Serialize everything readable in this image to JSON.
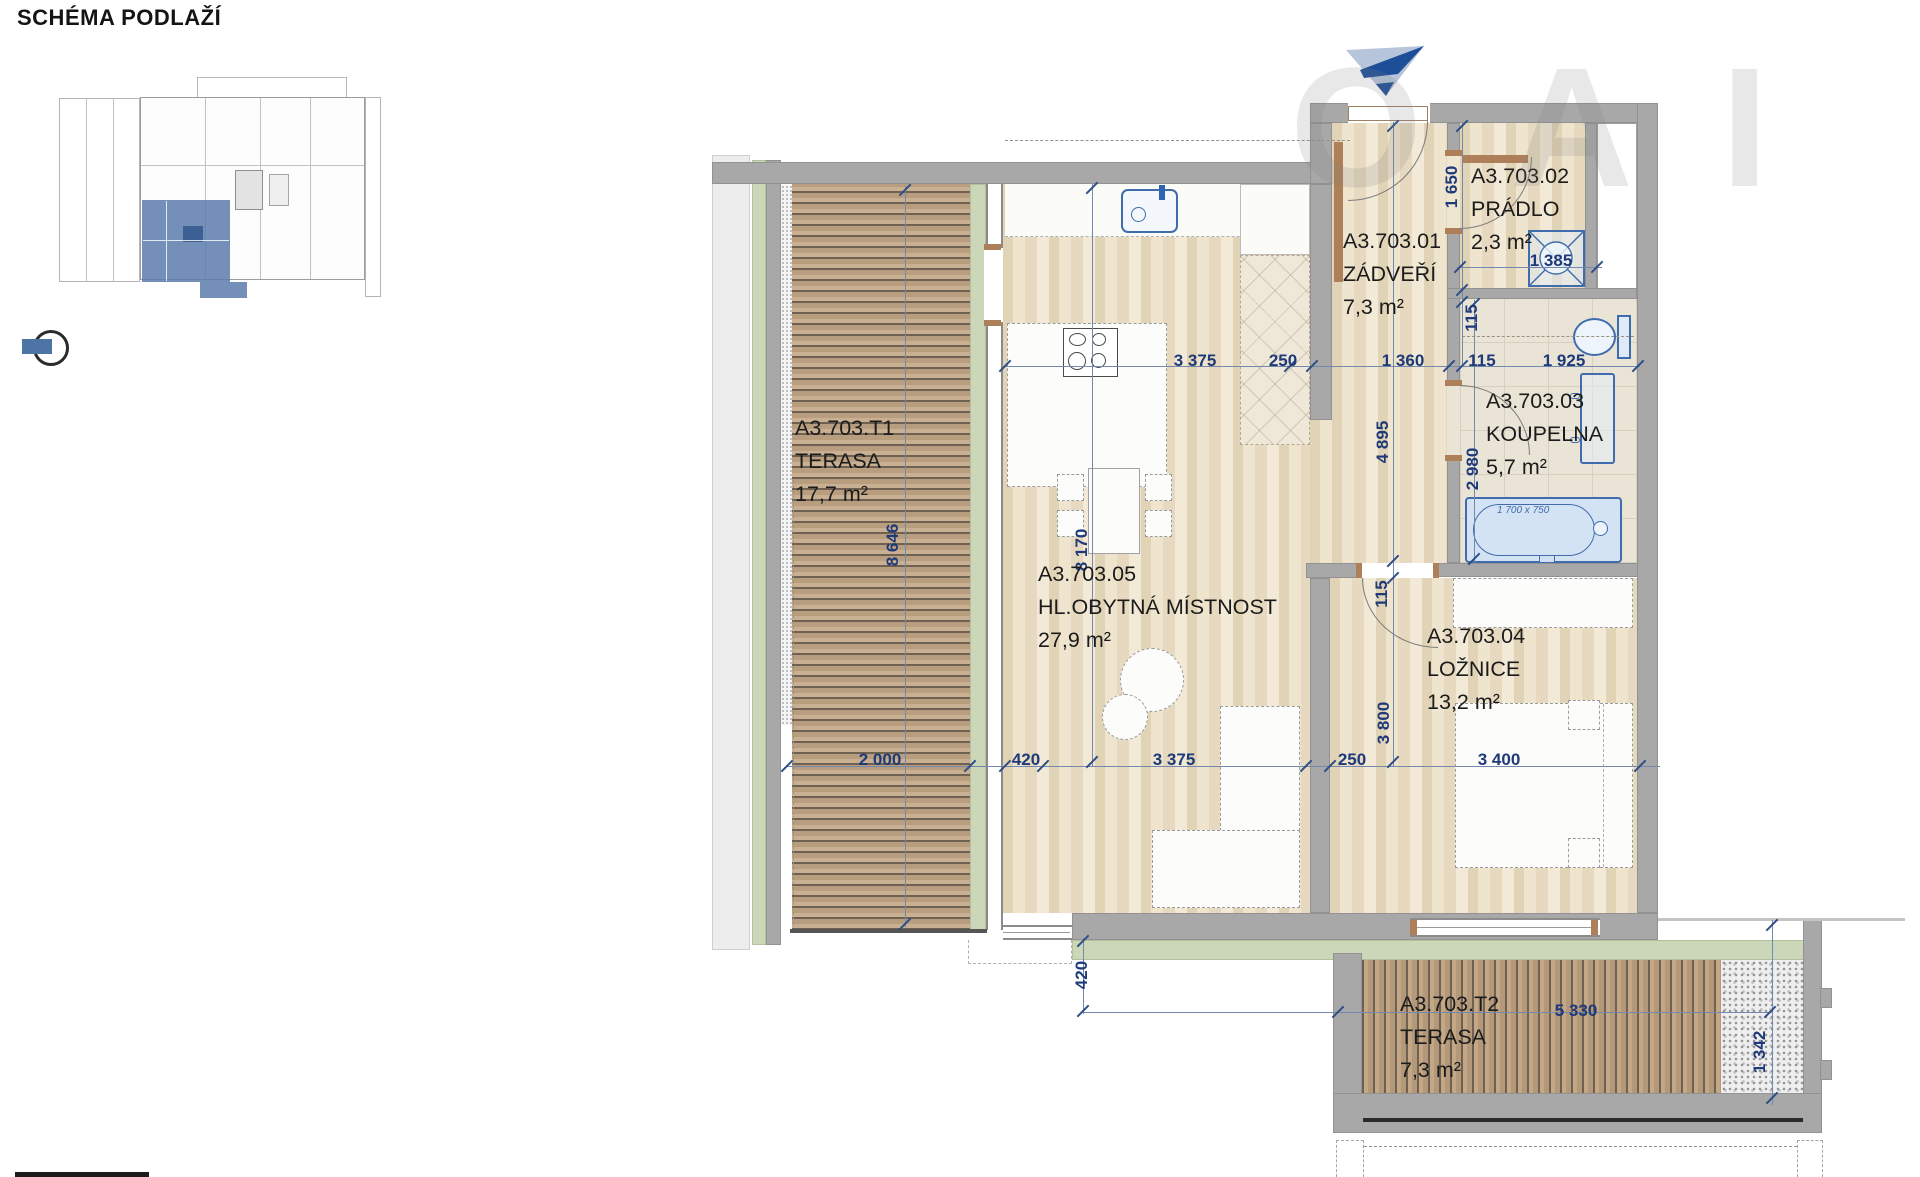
{
  "header": {
    "title": "SCHÉMA PODLAŽÍ"
  },
  "watermark": {
    "text": "OAI"
  },
  "icons": {
    "north_arrow": "north-arrow",
    "position_marker": "position-marker"
  },
  "rooms": [
    {
      "id": "A3.703.T1",
      "name": "TERASA",
      "area": "17,7 m²"
    },
    {
      "id": "A3.703.01",
      "name": "ZÁDVEŘÍ",
      "area": "7,3 m²"
    },
    {
      "id": "A3.703.02",
      "name": "PRÁDLO",
      "area": "2,3 m²"
    },
    {
      "id": "A3.703.03",
      "name": "KOUPELNA",
      "area": "5,7 m²"
    },
    {
      "id": "A3.703.04",
      "name": "LOŽNICE",
      "area": "13,2 m²"
    },
    {
      "id": "A3.703.05",
      "name": "HL.OBYTNÁ MÍSTNOST",
      "area": "27,9 m²"
    },
    {
      "id": "A3.703.T2",
      "name": "TERASA",
      "area": "7,3 m²"
    }
  ],
  "dims": {
    "top": [
      "3 375",
      "250",
      "1 360",
      "115",
      "1 925"
    ],
    "bottom": [
      "2 000",
      "420",
      "3 375",
      "250",
      "3 400"
    ],
    "left": [
      "8 646",
      "8 170"
    ],
    "right_outer": [
      "1 650",
      "115",
      "2 980"
    ],
    "right_inner": [
      "4 895",
      "115",
      "3 800"
    ],
    "pradlo": [
      "1 385"
    ],
    "terrace2": [
      "420",
      "5 330",
      "1 342"
    ],
    "bathtub": "1 700 x 750"
  },
  "colors": {
    "dimension_text": "#1e3a78",
    "room_text": "#1b1b1b",
    "wall": "#a8a8a8",
    "green_strip": "#ccd7ba",
    "deck_wood": "#bda083",
    "interior_floor": "#eadfc7",
    "fixture_blue": "#3f6cac",
    "highlight_unit": "#5d7dab"
  }
}
